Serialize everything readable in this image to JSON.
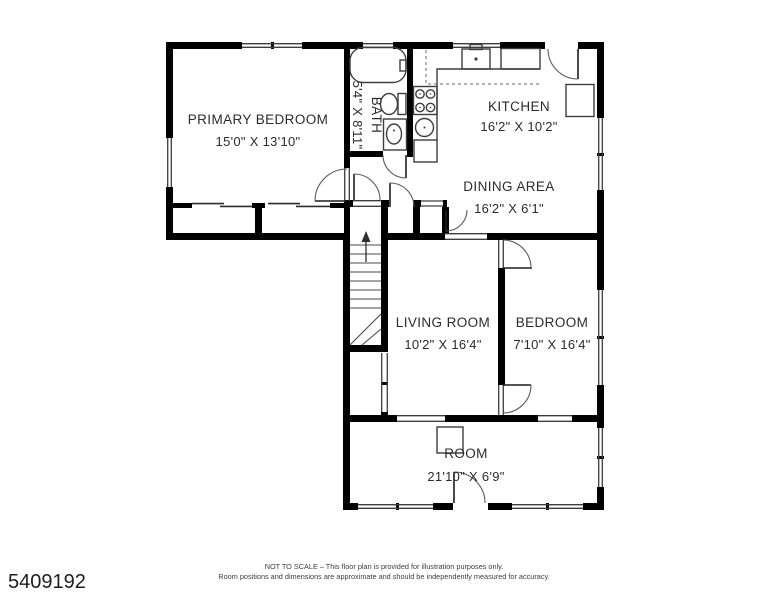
{
  "plan": {
    "id_number": "5409192",
    "footer_line1": "NOT TO SCALE – This floor plan is provided for illustration purposes only.",
    "footer_line2": "Room positions and dimensions are approximate and should be independently measured for accuracy.",
    "rooms": [
      {
        "name": "PRIMARY BEDROOM",
        "dims": "15'0\" X 13'10\""
      },
      {
        "name": "BATH",
        "dims": "5'4\" X 8'11\""
      },
      {
        "name": "KITCHEN",
        "dims": "16'2\" X 10'2\""
      },
      {
        "name": "DINING AREA",
        "dims": "16'2\" X 6'1\""
      },
      {
        "name": "LIVING ROOM",
        "dims": "10'2\" X 16'4\""
      },
      {
        "name": "BEDROOM",
        "dims": "7'10\" X 16'4\""
      },
      {
        "name": "ROOM",
        "dims": "21'10\" X 6'9\""
      }
    ],
    "fixtures": [
      "bathtub",
      "toilet",
      "bathroom-sink",
      "kitchen-sink",
      "stove",
      "refrigerator",
      "pantry",
      "under-counter-cabinet",
      "stairs",
      "chimney"
    ],
    "colors": {
      "wall": "#000000",
      "line": "#3d3d3d",
      "text": "#2c2c2c",
      "background": "#ffffff"
    }
  }
}
